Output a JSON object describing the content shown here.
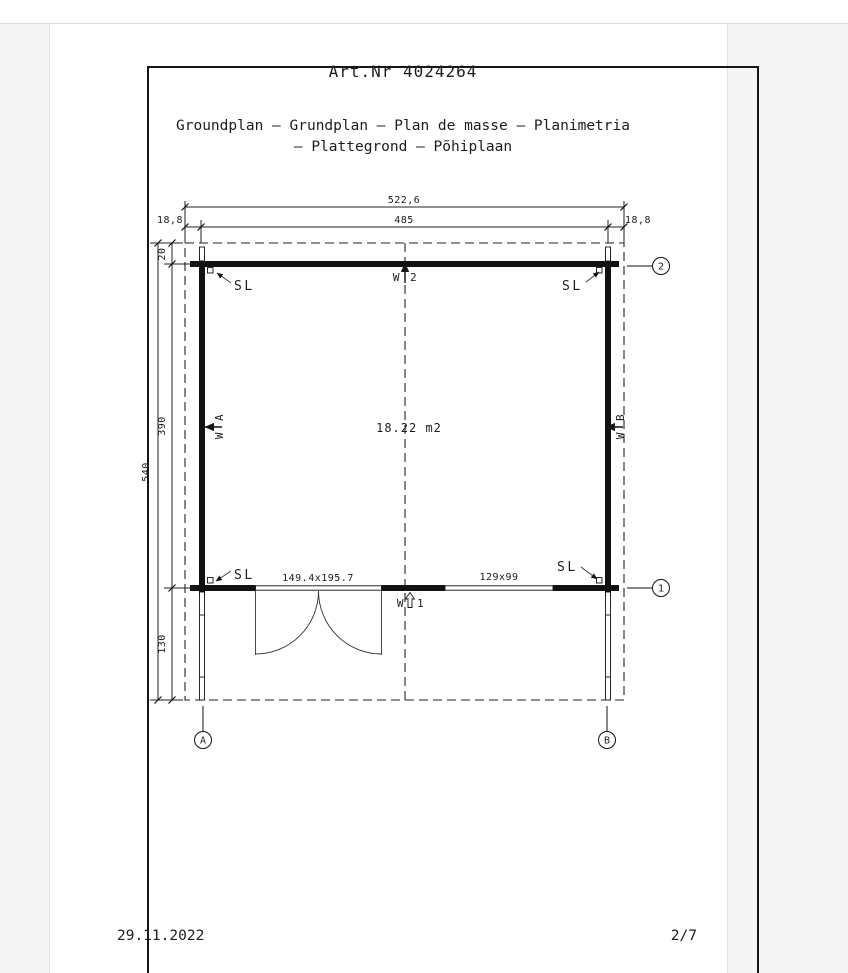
{
  "doc": {
    "art_nr": "Art.Nr 4024264",
    "subtitle_line1": "Groundplan – Grundplan – Plan de masse – Planimetria",
    "subtitle_line2": "– Plattegrond – Põhiplaan",
    "date": "29.11.2022",
    "page_indicator": "2/7"
  },
  "plan": {
    "area_label": "18.22 m2",
    "sl_label": "SL",
    "wall_prefix": "W",
    "wall_ids": {
      "top": "2",
      "bottom": "1",
      "left": "A",
      "right": "B"
    },
    "axes": {
      "row_top": "2",
      "row_bottom": "1",
      "col_a": "A",
      "col_b": "B"
    },
    "dims": {
      "total_width": "522,6",
      "inner_width": "485",
      "overhang_left": "18,8",
      "overhang_right": "18,8",
      "total_depth": "540",
      "top_overhang": "20",
      "room_depth": "390",
      "terrace_depth": "130",
      "door": "149.4x195.7",
      "window": "129x99"
    }
  }
}
